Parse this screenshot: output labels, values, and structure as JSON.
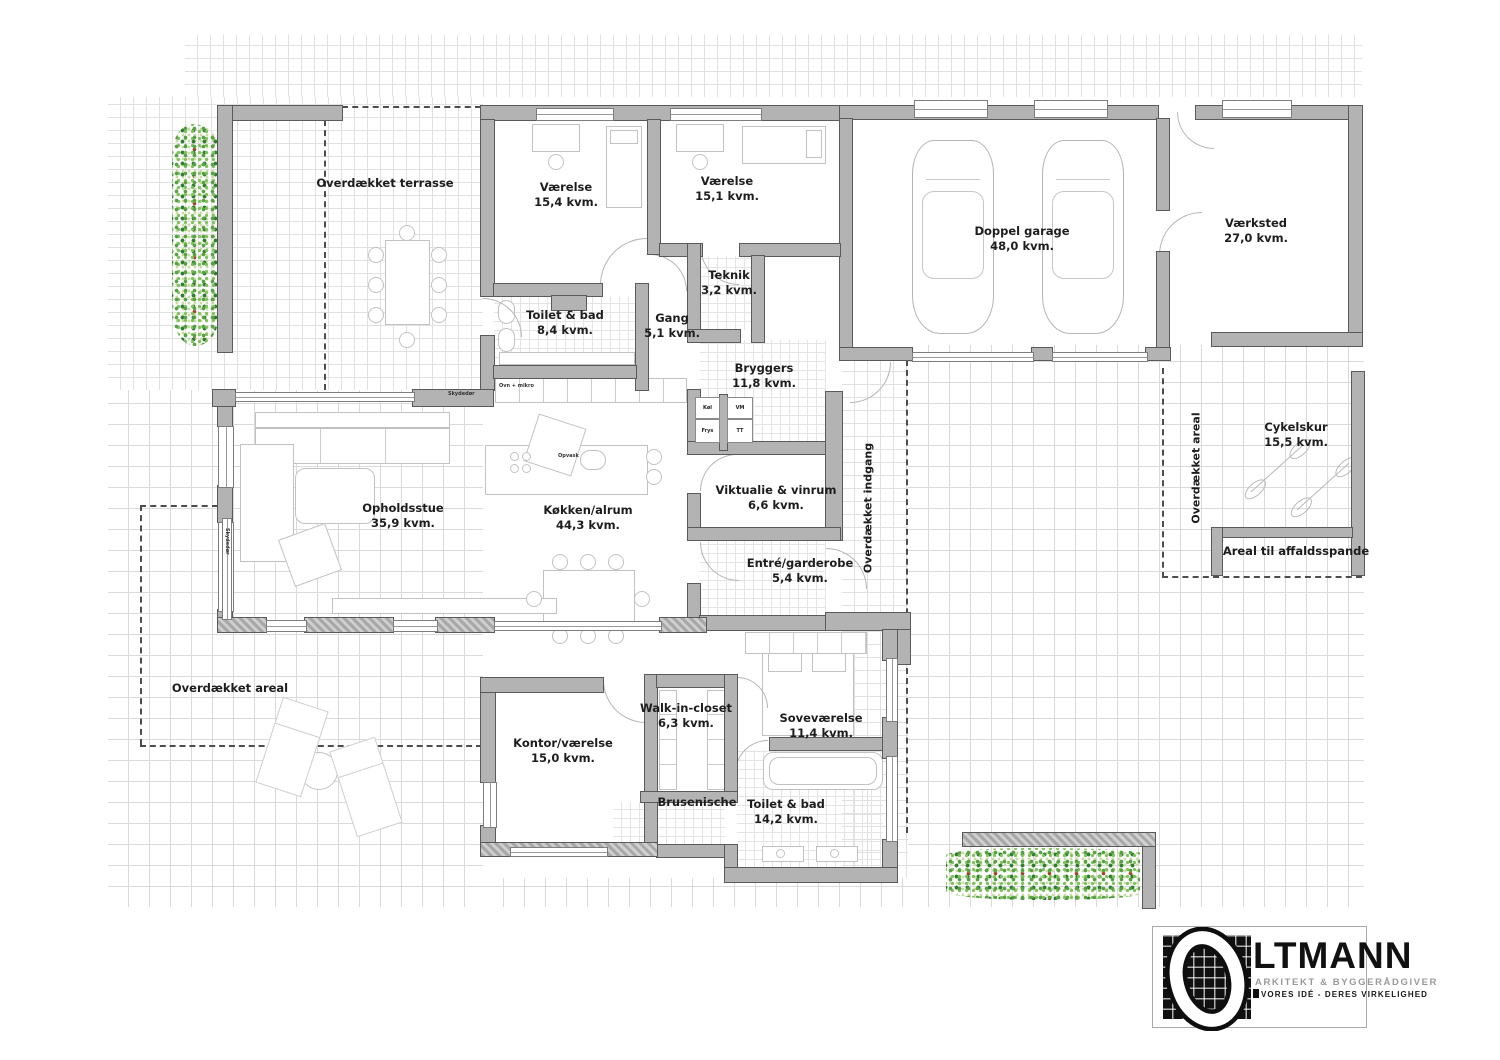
{
  "rooms": [
    {
      "name": "Værelse",
      "area": "15,4 kvm."
    },
    {
      "name": "Værelse",
      "area": "15,1 kvm."
    },
    {
      "name": "Teknik",
      "area": "3,2 kvm."
    },
    {
      "name": "Toilet & bad",
      "area": "8,4 kvm."
    },
    {
      "name": "Gang",
      "area": "5,1 kvm."
    },
    {
      "name": "Bryggers",
      "area": "11,8 kvm."
    },
    {
      "name": "Doppel garage",
      "area": "48,0 kvm."
    },
    {
      "name": "Værksted",
      "area": "27,0 kvm."
    },
    {
      "name": "Opholdsstue",
      "area": "35,9 kvm."
    },
    {
      "name": "Køkken/alrum",
      "area": "44,3 kvm."
    },
    {
      "name": "Viktualie & vinrum",
      "area": "6,6 kvm."
    },
    {
      "name": "Entré/garderobe",
      "area": "5,4 kvm."
    },
    {
      "name": "Kontor/værelse",
      "area": "15,0 kvm."
    },
    {
      "name": "Walk-in-closet",
      "area": "6,3 kvm."
    },
    {
      "name": "Soveværelse",
      "area": "11,4 kvm."
    },
    {
      "name": "Brusenische",
      "area": ""
    },
    {
      "name": "Toilet & bad",
      "area": "14,2 kvm."
    },
    {
      "name": "Cykelskur",
      "area": "15,5 kvm."
    }
  ],
  "outdoor_labels": {
    "terrace": "Overdækket terrasse",
    "entrance": "Overdækket indgang",
    "areal_right": "Overdækket areal",
    "areal_left": "Overdækket areal",
    "waste": "Areal til affaldsspande"
  },
  "appliance_labels": {
    "fridge": "Køl",
    "freezer": "Frys",
    "washing_machine": "VM",
    "dryer": "TT",
    "oven_cabinet": "Ovn + mikro",
    "dishwasher": "Opvask"
  },
  "annotation_labels": {
    "sliding_door": "Skydedør"
  },
  "logo": {
    "initial": "O",
    "name": "LTMANN",
    "tagline": "ARKITEKT & BYGGERÅDGIVER",
    "slogan": "VORES IDÉ - DERES VIRKELIGHED"
  },
  "colors": {
    "wall": "#b3b3b3",
    "wall_outline": "#5a5a5a",
    "grid_line": "#dcdcdc",
    "dash": "#4d4d4d",
    "shrub_green": "#57a044",
    "shrub_accent": "#a3402f",
    "logo_black": "#111111",
    "logo_gray": "#9a9a9a"
  }
}
